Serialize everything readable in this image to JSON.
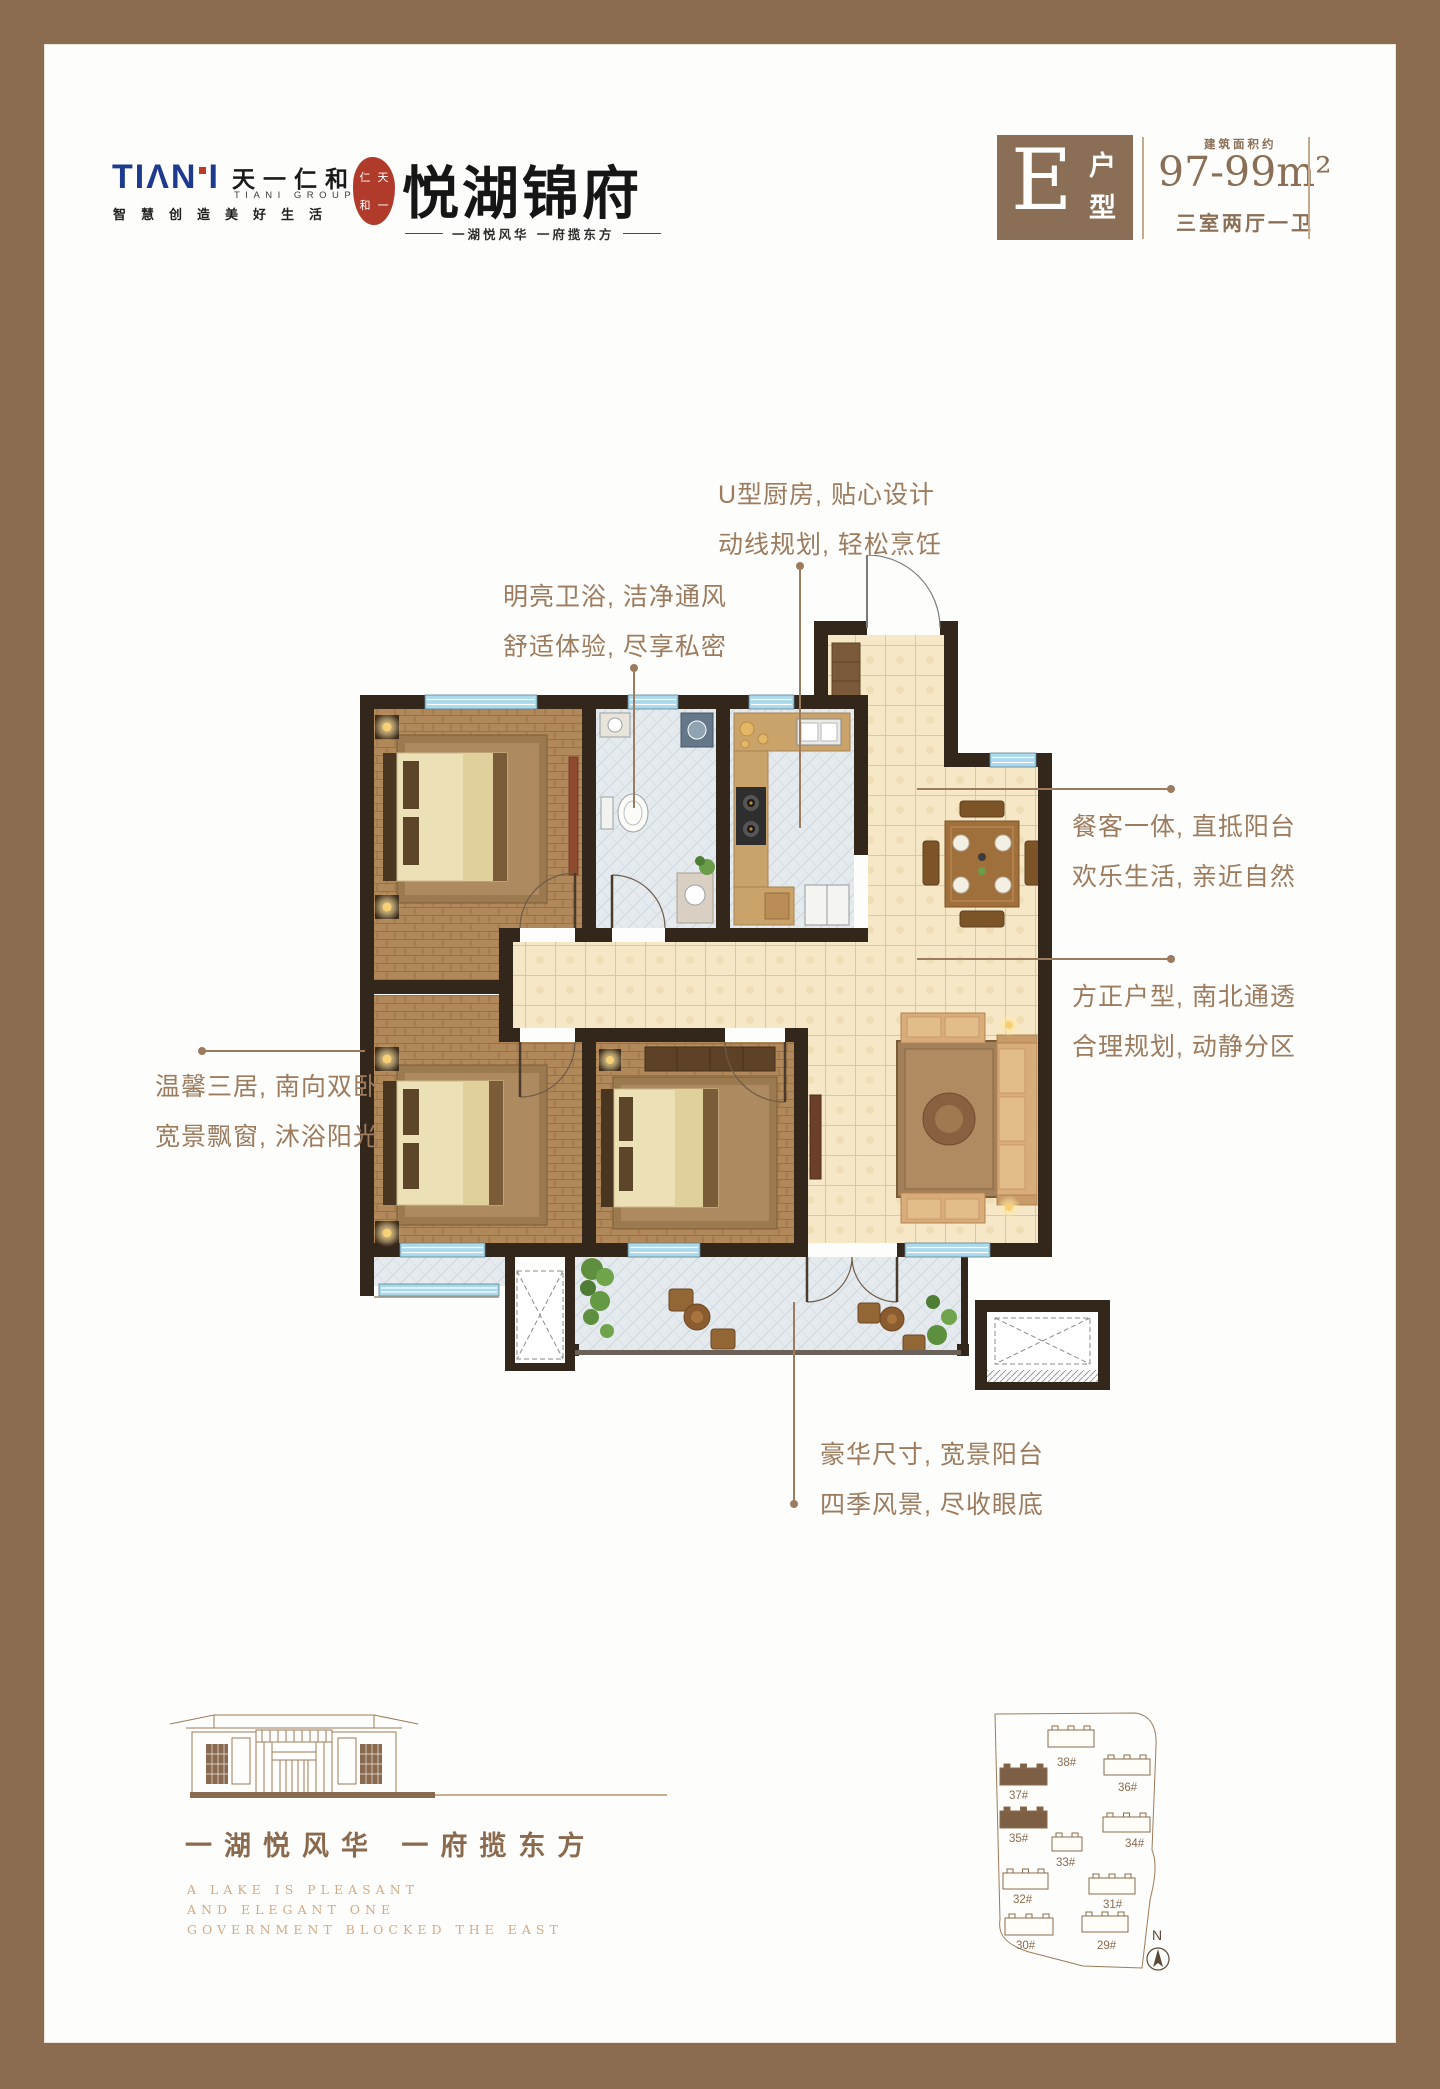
{
  "header": {
    "logo": {
      "wordmark_left": "TIΛN",
      "wordmark_right": "I",
      "name_cn": "天一仁和",
      "group_en": "TIANI GROUP",
      "slogan": "智慧创造美好生活",
      "seal_chars": [
        "仁",
        "天",
        "和",
        "一"
      ],
      "brand": "悦湖锦府",
      "tagline": "一湖悦风华  一府揽东方"
    },
    "unit": {
      "letter": "E",
      "type_label": "户型",
      "area_label": "建筑面积约",
      "area_value": "97-99m²",
      "rooms": "三室两厅一卫"
    }
  },
  "annotations": [
    {
      "lines": [
        "U型厨房, 贴心设计",
        "动线规划, 轻松烹饪"
      ]
    },
    {
      "lines": [
        "明亮卫浴, 洁净通风",
        "舒适体验, 尽享私密"
      ]
    },
    {
      "lines": [
        "餐客一体, 直抵阳台",
        "欢乐生活, 亲近自然"
      ]
    },
    {
      "lines": [
        "方正户型, 南北通透",
        "合理规划, 动静分区"
      ]
    },
    {
      "lines": [
        "温馨三居, 南向双卧",
        "宽景飘窗, 沐浴阳光"
      ]
    },
    {
      "lines": [
        "豪华尺寸, 宽景阳台",
        "四季风景, 尽收眼底"
      ]
    }
  ],
  "footer": {
    "slogan_cn": "一湖悦风华  一府揽东方",
    "slogan_en": [
      "A LAKE IS PLEASANT",
      "AND ELEGANT ONE",
      "GOVERNMENT BLOCKED THE EAST"
    ]
  },
  "siteplan": {
    "compass": "N",
    "buildings": [
      {
        "label": "38#",
        "x": 63,
        "y": 28,
        "w": 46,
        "h": 17,
        "filled": false,
        "lx": 72,
        "ly": 64
      },
      {
        "label": "36#",
        "x": 119,
        "y": 57,
        "w": 46,
        "h": 16,
        "filled": false,
        "lx": 133,
        "ly": 89
      },
      {
        "label": "37#",
        "x": 15,
        "y": 66,
        "w": 47,
        "h": 17,
        "filled": true,
        "lx": 24,
        "ly": 97
      },
      {
        "label": "35#",
        "x": 15,
        "y": 109,
        "w": 47,
        "h": 17,
        "filled": true,
        "lx": 24,
        "ly": 140
      },
      {
        "label": "33#",
        "x": 67,
        "y": 135,
        "w": 30,
        "h": 14,
        "filled": false,
        "lx": 71,
        "ly": 164
      },
      {
        "label": "34#",
        "x": 118,
        "y": 115,
        "w": 47,
        "h": 15,
        "filled": false,
        "lx": 140,
        "ly": 145
      },
      {
        "label": "32#",
        "x": 18,
        "y": 171,
        "w": 45,
        "h": 16,
        "filled": false,
        "lx": 28,
        "ly": 201
      },
      {
        "label": "31#",
        "x": 104,
        "y": 176,
        "w": 46,
        "h": 16,
        "filled": false,
        "lx": 118,
        "ly": 206
      },
      {
        "label": "30#",
        "x": 20,
        "y": 216,
        "w": 48,
        "h": 17,
        "filled": false,
        "lx": 31,
        "ly": 247
      },
      {
        "label": "29#",
        "x": 97,
        "y": 214,
        "w": 46,
        "h": 16,
        "filled": false,
        "lx": 112,
        "ly": 247
      }
    ]
  },
  "colors": {
    "frame": "#8c6c51",
    "accent": "#8a6e55",
    "annotation": "#9c7b5e",
    "logo_blue": "#1e3a8f",
    "seal_red": "#b13b2b",
    "wall": "#33261b",
    "wood_floor": "#b0885a",
    "beige_tile": "#f6e8c7",
    "cool_tile": "#e4eaee",
    "window_blue": "#a9d9ec"
  }
}
